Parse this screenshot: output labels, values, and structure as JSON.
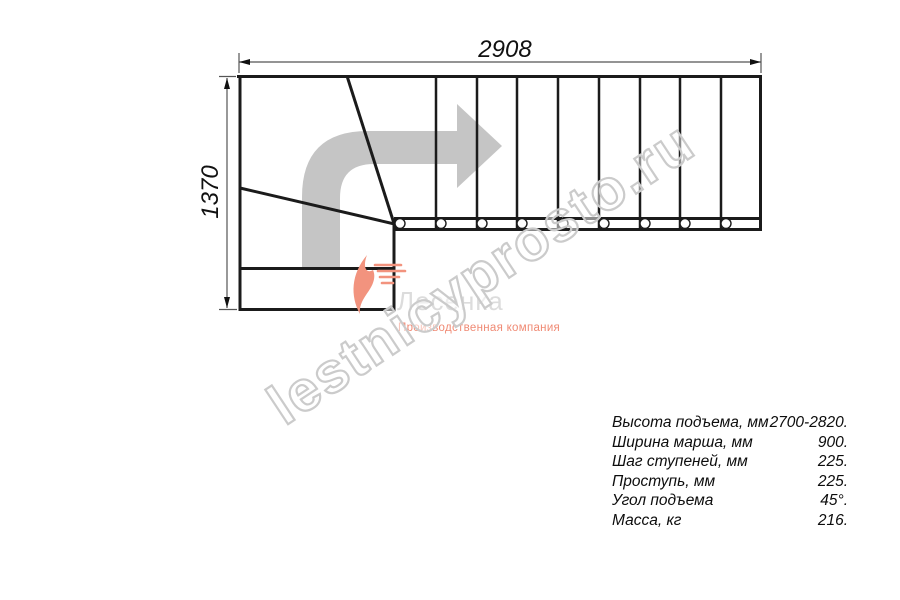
{
  "drawing": {
    "title": "L-shaped staircase plan view",
    "top_dimension": "2908",
    "left_dimension": "1370",
    "step_count_straight_flight": 9
  },
  "watermark": {
    "text": "lestnicyprosto.ru"
  },
  "logo": {
    "name": "Лесенка",
    "tagline": "Производственная компания"
  },
  "specs": {
    "rows": [
      {
        "label": "Высота подъема, мм",
        "value": "2700-2820."
      },
      {
        "label": "Ширина марша, мм",
        "value": "900."
      },
      {
        "label": "Шаг ступеней, мм",
        "value": "225."
      },
      {
        "label": "Проступь, мм",
        "value": "225."
      },
      {
        "label": "Угол подъема",
        "value": "45°."
      },
      {
        "label": "Масса, кг",
        "value": "216."
      }
    ]
  },
  "colors": {
    "outline": "#1b1b1b",
    "dimension": "#555555",
    "direction_arrow": "#c5c5c5",
    "watermark": "#cbcbcb",
    "logo_gray": "#dcdcdc",
    "logo_salmon": "#f08a74"
  }
}
